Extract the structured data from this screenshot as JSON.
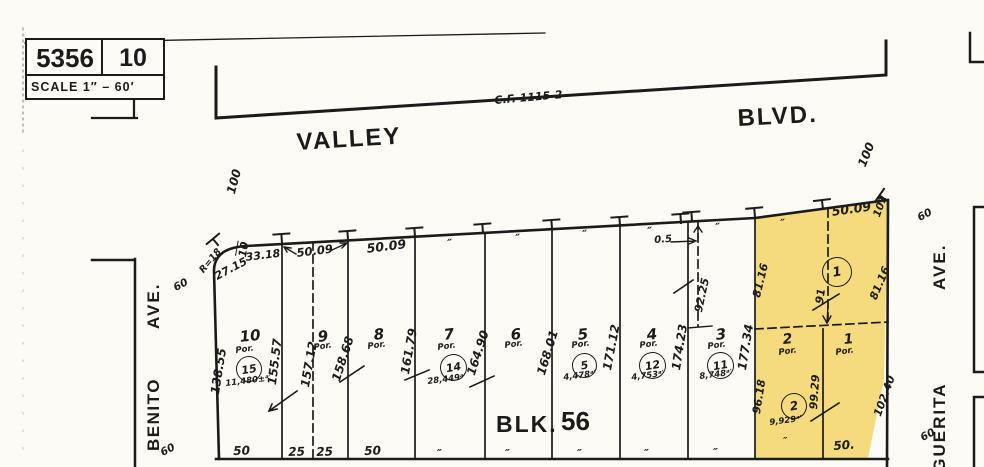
{
  "colors": {
    "paper": "#fcfbf6",
    "ink": "#1b1b1b",
    "highlight": "#f5db7e"
  },
  "title_block": {
    "map_book": "5356",
    "page": "10",
    "scale": "SCALE 1″ – 60′"
  },
  "block": {
    "label": "BLK.",
    "number": "56"
  },
  "streets": {
    "north": {
      "name": "VALLEY",
      "suffix": "BLVD.",
      "reference": "C.F. 1115-2"
    },
    "west": {
      "name": "BENITO",
      "suffix": "AVE.",
      "width": "60"
    },
    "east": {
      "name_visible": "RGUERITA",
      "suffix": "AVE.",
      "width": "60"
    }
  },
  "labels": [
    {
      "name": "street-valley",
      "text": "VALLEY",
      "x": 296,
      "y": 131,
      "rot": -3.5,
      "fs": 24,
      "ls": 2,
      "cls": "p"
    },
    {
      "name": "street-blvd",
      "text": "BLVD.",
      "x": 737,
      "y": 107,
      "rot": -3,
      "fs": 24,
      "ls": 2,
      "cls": "p"
    },
    {
      "name": "cf-reference",
      "text": "C.F. 1115-2",
      "x": 494,
      "y": 95,
      "rot": -5,
      "fs": 11
    },
    {
      "name": "street-benito-ave",
      "text": "AVE.",
      "x": 145,
      "y": 329,
      "rot": -90,
      "fs": 17,
      "ls": 2,
      "cls": "p"
    },
    {
      "name": "street-benito",
      "text": "BENITO",
      "x": 145,
      "y": 451,
      "rot": -90,
      "fs": 17,
      "ls": 1.5,
      "cls": "p"
    },
    {
      "name": "street-marguerita-ave",
      "text": "AVE.",
      "x": 931,
      "y": 290,
      "rot": -90,
      "fs": 17,
      "ls": 2,
      "cls": "p"
    },
    {
      "name": "street-marguerita",
      "text": "RGUERITA",
      "x": 931,
      "y": 486,
      "rot": -90,
      "fs": 17,
      "ls": 2,
      "cls": "p"
    },
    {
      "name": "block-label",
      "text": "BLK.",
      "x": 496,
      "y": 413,
      "rot": 0,
      "fs": 23,
      "ls": 2,
      "cls": "p"
    },
    {
      "name": "block-number",
      "text": "56",
      "x": 561,
      "y": 408,
      "rot": 0,
      "fs": 26,
      "cls": "p"
    },
    {
      "name": "width-60-benito-top",
      "text": "60",
      "x": 172,
      "y": 284,
      "rot": -28,
      "fs": 10.5
    },
    {
      "name": "width-60-benito-bottom",
      "text": "60",
      "x": 159,
      "y": 449,
      "rot": -28,
      "fs": 10.5
    },
    {
      "name": "width-60-marguerita-top",
      "text": "60",
      "x": 916,
      "y": 214,
      "rot": -28,
      "fs": 10.5
    },
    {
      "name": "width-60-marguerita-bottom",
      "text": "60",
      "x": 919,
      "y": 434,
      "rot": -28,
      "fs": 10.5
    },
    {
      "name": "dim-100-left",
      "text": "100",
      "x": 225,
      "y": 192,
      "rot": -75,
      "fs": 12
    },
    {
      "name": "dim-100-right",
      "text": "100",
      "x": 856,
      "y": 164,
      "rot": -68,
      "fs": 12
    },
    {
      "name": "dim-101",
      "text": "101",
      "x": 872,
      "y": 215,
      "rot": -70,
      "fs": 10.5
    },
    {
      "name": "dim-10-corner",
      "text": "10",
      "x": 237,
      "y": 256,
      "rot": -80,
      "fs": 11,
      "cls": "ovl"
    },
    {
      "name": "dim-r18",
      "text": "R=18",
      "x": 198,
      "y": 269,
      "rot": -50,
      "fs": 9.5
    },
    {
      "name": "dim-27-15",
      "text": "27.15",
      "x": 213,
      "y": 272,
      "rot": -28,
      "fs": 11
    },
    {
      "name": "dim-33-18",
      "text": "33.18",
      "x": 245,
      "y": 252,
      "rot": -7,
      "fs": 11
    },
    {
      "name": "dim-50-09-a",
      "text": "50.09",
      "x": 296,
      "y": 248,
      "rot": -7,
      "fs": 11.5
    },
    {
      "name": "dim-50-09-b",
      "text": "50.09",
      "x": 366,
      "y": 243,
      "rot": -7,
      "fs": 12.5
    },
    {
      "name": "dim-50-09-c",
      "text": "50.09",
      "x": 831,
      "y": 206,
      "rot": -8,
      "fs": 12.5
    },
    {
      "name": "dim-0-5",
      "text": "0.5",
      "x": 654,
      "y": 236,
      "rot": -4,
      "fs": 10
    },
    {
      "name": "ditto-frontage-1",
      "text": "″",
      "x": 447,
      "y": 238,
      "rot": -5,
      "fs": 11
    },
    {
      "name": "ditto-frontage-2",
      "text": "″",
      "x": 515,
      "y": 233,
      "rot": -5,
      "fs": 11
    },
    {
      "name": "ditto-frontage-3",
      "text": "″",
      "x": 582,
      "y": 229,
      "rot": -5,
      "fs": 11
    },
    {
      "name": "ditto-frontage-4",
      "text": "″",
      "x": 647,
      "y": 226,
      "rot": -5,
      "fs": 11
    },
    {
      "name": "ditto-frontage-5",
      "text": "″",
      "x": 715,
      "y": 222,
      "rot": -5,
      "fs": 11
    },
    {
      "name": "ditto-frontage-6",
      "text": "″",
      "x": 780,
      "y": 218,
      "rot": -5,
      "fs": 11
    },
    {
      "name": "dim-138-55",
      "text": "138.55",
      "x": 209,
      "y": 393,
      "rot": -81,
      "fs": 12
    },
    {
      "name": "dim-155-57",
      "text": "155.57",
      "x": 266,
      "y": 384,
      "rot": -83,
      "fs": 12
    },
    {
      "name": "dim-157-12",
      "text": "157.12",
      "x": 299,
      "y": 386,
      "rot": -80,
      "fs": 12
    },
    {
      "name": "dim-158-68",
      "text": "158.68",
      "x": 330,
      "y": 379,
      "rot": -72,
      "fs": 12
    },
    {
      "name": "dim-161-79",
      "text": "161.79",
      "x": 399,
      "y": 373,
      "rot": -80,
      "fs": 12
    },
    {
      "name": "dim-164-90",
      "text": "164.90",
      "x": 465,
      "y": 373,
      "rot": -72,
      "fs": 12
    },
    {
      "name": "dim-168-01",
      "text": "168.01",
      "x": 535,
      "y": 373,
      "rot": -73,
      "fs": 12
    },
    {
      "name": "dim-171-12",
      "text": "171.12",
      "x": 601,
      "y": 369,
      "rot": -79,
      "fs": 12
    },
    {
      "name": "dim-174-23",
      "text": "174.23",
      "x": 670,
      "y": 369,
      "rot": -81,
      "fs": 12
    },
    {
      "name": "dim-177-34",
      "text": "177.34",
      "x": 736,
      "y": 369,
      "rot": -81,
      "fs": 12
    },
    {
      "name": "dim-92-25",
      "text": "92.25",
      "x": 693,
      "y": 311,
      "rot": -78,
      "fs": 11
    },
    {
      "name": "dim-91",
      "text": "91",
      "x": 814,
      "y": 303,
      "rot": -82,
      "fs": 11
    },
    {
      "name": "dim-81-16-left",
      "text": "81.16",
      "x": 751,
      "y": 296,
      "rot": -76,
      "fs": 11
    },
    {
      "name": "dim-81-16-right",
      "text": "81.16",
      "x": 868,
      "y": 297,
      "rot": -67,
      "fs": 11
    },
    {
      "name": "dim-96-18",
      "text": "96.18",
      "x": 751,
      "y": 413,
      "rot": -81,
      "fs": 11
    },
    {
      "name": "dim-99-29",
      "text": "99.29",
      "x": 808,
      "y": 409,
      "rot": -86,
      "fs": 11
    },
    {
      "name": "dim-102-40",
      "text": "102.40",
      "x": 872,
      "y": 414,
      "rot": -70,
      "fs": 11
    },
    {
      "name": "lot-10-number",
      "text": "10",
      "x": 239,
      "y": 330,
      "rot": -6,
      "fs": 15
    },
    {
      "name": "lot-10-por",
      "text": "Por.",
      "x": 235,
      "y": 347,
      "rot": -8,
      "fs": 8.5
    },
    {
      "name": "lot-10-area",
      "text": "11,480±ᵃ′",
      "x": 225,
      "y": 380,
      "rot": -7,
      "fs": 8.5
    },
    {
      "name": "lot-9-number",
      "text": "9",
      "x": 317,
      "y": 330,
      "rot": -6,
      "fs": 15
    },
    {
      "name": "lot-9-por",
      "text": "Por.",
      "x": 313,
      "y": 344,
      "rot": -8,
      "fs": 8.5
    },
    {
      "name": "lot-8-number",
      "text": "8",
      "x": 373,
      "y": 328,
      "rot": -6,
      "fs": 15
    },
    {
      "name": "lot-8-por",
      "text": "Por.",
      "x": 367,
      "y": 343,
      "rot": -8,
      "fs": 8.5
    },
    {
      "name": "lot-7-number",
      "text": "7",
      "x": 443,
      "y": 328,
      "rot": -6,
      "fs": 15
    },
    {
      "name": "lot-7-por",
      "text": "Por.",
      "x": 437,
      "y": 344,
      "rot": -8,
      "fs": 8.5
    },
    {
      "name": "lot-7-area",
      "text": "28,449ᵃ′",
      "x": 427,
      "y": 378,
      "rot": -7,
      "fs": 8.5
    },
    {
      "name": "lot-6-number",
      "text": "6",
      "x": 510,
      "y": 328,
      "rot": -6,
      "fs": 15
    },
    {
      "name": "lot-6-por",
      "text": "Por.",
      "x": 504,
      "y": 342,
      "rot": -8,
      "fs": 8.5
    },
    {
      "name": "lot-5-number",
      "text": "5",
      "x": 577,
      "y": 328,
      "rot": -6,
      "fs": 15
    },
    {
      "name": "lot-5-por",
      "text": "Por.",
      "x": 571,
      "y": 342,
      "rot": -8,
      "fs": 8.5
    },
    {
      "name": "lot-5-area",
      "text": "4,478ᵃ′",
      "x": 563,
      "y": 374,
      "rot": -7,
      "fs": 8.5
    },
    {
      "name": "lot-4-number",
      "text": "4",
      "x": 646,
      "y": 328,
      "rot": -6,
      "fs": 15
    },
    {
      "name": "lot-4-por",
      "text": "Por.",
      "x": 639,
      "y": 342,
      "rot": -8,
      "fs": 8.5
    },
    {
      "name": "lot-4-area",
      "text": "4,753ᵃ′",
      "x": 631,
      "y": 374,
      "rot": -7,
      "fs": 8.5
    },
    {
      "name": "lot-3-number",
      "text": "3",
      "x": 715,
      "y": 328,
      "rot": -6,
      "fs": 15
    },
    {
      "name": "lot-3-por",
      "text": "Por.",
      "x": 707,
      "y": 343,
      "rot": -8,
      "fs": 8.5
    },
    {
      "name": "lot-3-area",
      "text": "8,748ᵃ′",
      "x": 699,
      "y": 373,
      "rot": -7,
      "fs": 8.5
    },
    {
      "name": "lot-2-number",
      "text": "2",
      "x": 782,
      "y": 333,
      "rot": -6,
      "fs": 14
    },
    {
      "name": "lot-2-por",
      "text": "Por.",
      "x": 778,
      "y": 349,
      "rot": -8,
      "fs": 8.5
    },
    {
      "name": "lot-2-area",
      "text": "9,929ᵃ′",
      "x": 769,
      "y": 419,
      "rot": -7,
      "fs": 8.5
    },
    {
      "name": "lot-1-number",
      "text": "1",
      "x": 843,
      "y": 333,
      "rot": -6,
      "fs": 14
    },
    {
      "name": "lot-1-por",
      "text": "Por.",
      "x": 835,
      "y": 349,
      "rot": -8,
      "fs": 8.5
    },
    {
      "name": "bottom-dim-50-lot10",
      "text": "50",
      "x": 233,
      "y": 445,
      "rot": -2,
      "fs": 12
    },
    {
      "name": "bottom-dim-25-a",
      "text": "25",
      "x": 288,
      "y": 446,
      "rot": -2,
      "fs": 12
    },
    {
      "name": "bottom-dim-25-b",
      "text": "25",
      "x": 316,
      "y": 446,
      "rot": -2,
      "fs": 12
    },
    {
      "name": "bottom-dim-50-lot8",
      "text": "50",
      "x": 364,
      "y": 445,
      "rot": -2,
      "fs": 12
    },
    {
      "name": "ditto-bottom-1",
      "text": "″",
      "x": 437,
      "y": 448,
      "rot": 0,
      "fs": 11
    },
    {
      "name": "ditto-bottom-2",
      "text": "″",
      "x": 505,
      "y": 448,
      "rot": 0,
      "fs": 11
    },
    {
      "name": "ditto-bottom-3",
      "text": "″",
      "x": 577,
      "y": 448,
      "rot": 0,
      "fs": 11
    },
    {
      "name": "ditto-bottom-4",
      "text": "″",
      "x": 644,
      "y": 448,
      "rot": 0,
      "fs": 11
    },
    {
      "name": "ditto-bottom-5",
      "text": "″",
      "x": 713,
      "y": 447,
      "rot": 0,
      "fs": 11
    },
    {
      "name": "ditto-bottom-lot2",
      "text": "″",
      "x": 783,
      "y": 437,
      "rot": 0,
      "fs": 10
    },
    {
      "name": "bottom-dim-50-lot1",
      "text": "50.",
      "x": 833,
      "y": 440,
      "rot": -4,
      "fs": 12
    }
  ],
  "circles": [
    {
      "name": "parcel-circle-15",
      "text": "15",
      "x": 236,
      "y": 356,
      "d": 24,
      "fs": 11
    },
    {
      "name": "parcel-circle-14",
      "text": "14",
      "x": 440,
      "y": 354,
      "d": 25,
      "fs": 11
    },
    {
      "name": "parcel-circle-5",
      "text": "5",
      "x": 572,
      "y": 353,
      "d": 23,
      "fs": 11
    },
    {
      "name": "parcel-circle-12",
      "text": "12",
      "x": 639,
      "y": 352,
      "d": 25,
      "fs": 11
    },
    {
      "name": "parcel-circle-11",
      "text": "11",
      "x": 707,
      "y": 352,
      "d": 25,
      "fs": 11
    },
    {
      "name": "parcel-circle-1",
      "text": "1",
      "x": 822,
      "y": 257,
      "d": 28,
      "fs": 13
    },
    {
      "name": "parcel-circle-2",
      "text": "2",
      "x": 781,
      "y": 393,
      "d": 24,
      "fs": 12
    }
  ]
}
